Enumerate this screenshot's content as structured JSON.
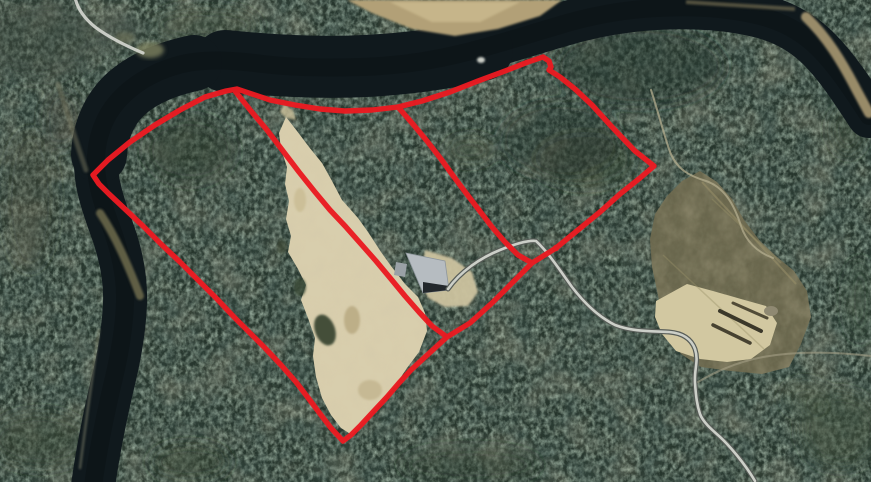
{
  "map": {
    "kind": "aerial-property-boundary-map",
    "colors": {
      "boundary_red": "#ea1b22",
      "forest_base": "#26352c",
      "river_water": "#10191d",
      "river_shadow": "#0b1216",
      "sand_pit": "#d8cead",
      "clearing_olive": "#6f6a4f",
      "clearing_sand": "#d2c8a1",
      "road_fill": "#cccfc8",
      "road_edge": "#585d58",
      "trail_light": "#d6d8d2",
      "trail_faint": "#b4ad8f",
      "building_roof": "#b6bcc1",
      "building_front": "#23282c",
      "sandbar_tan": "#b2a077",
      "bank_olive": "#6f6b4c"
    },
    "boundary": {
      "outer_points": "93,175 108,160 130,142 155,125 180,110 205,97 226,91 237,89 252,94 270,100 295,105 320,109 345,111 372,110 398,107 422,101 450,92 478,81 505,71 528,62 543,57 549,61 551,67 549,70 560,77 575,89 592,105 612,127 635,151 654,166 640,178 620,194 600,212 578,230 556,248 532,263 512,283 492,303 470,323 447,337 436,347 424,358 411,370 399,383 387,397 373,412 361,425 351,435 343,441 331,428 321,415 309,399 296,382 281,365 265,348 250,333 234,317 217,299 199,281 180,262 162,245 144,227 126,210 109,194 99,184",
      "divider_west_points": "235,91 251,111 267,130 283,151 299,172 315,192 330,210 346,227 361,244 376,261 391,279 405,296 419,312 432,326 447,337",
      "divider_east_points": "398,107 412,123 427,141 441,159 454,177 466,193 479,210 492,227 505,242 518,255 532,263",
      "node_cx": "556",
      "node_cy": "248"
    },
    "river": {
      "main_path": "M 93,486 C 98,450 105,416 112,386 C 119,358 124,331 125,303 C 126,276 120,250 110,224 C 101,199 95,179 96,157 C 97,137 104,117 117,102 C 131,86 151,73 175,66 C 201,58 231,60 263,64 C 297,68 331,68 361,67 C 396,66 431,61 463,53 C 496,45 526,35 557,26 C 589,16 621,10 656,8 C 691,6 726,8 756,15 C 783,21 803,33 819,49 C 837,67 852,90 869,116",
      "wide_mid_path": "M 225,61 C 275,66 325,68 365,66 C 408,64 448,58 482,50",
      "wide_bend_path": "M 99,155 C 100,130 110,108 127,93 C 143,79 166,69 194,63"
    },
    "features": {
      "sand_pit_path": "M 286,117 L 297,131 L 309,147 L 322,163 L 332,181 L 342,200 L 358,218 L 368,232 L 381,252 L 391,266 L 405,284 L 418,297 L 425,313 L 427,331 L 419,352 L 407,368 L 395,386 L 378,406 L 363,422 L 352,435 L 341,428 L 331,415 L 322,398 L 316,377 L 313,356 L 315,338 L 308,318 L 301,300 L 306,285 L 298,269 L 288,252 L 291,236 L 286,219 L 289,201 L 285,184 L 287,167 L 281,149 L 279,133 Z",
      "building_apron_path": "M 425,250 L 452,258 L 472,272 L 478,292 L 468,306 L 445,307 L 428,298 L 420,280 Z",
      "clearing_path": "M 655,214 L 667,196 L 682,181 L 700,171 L 717,182 L 732,199 L 744,220 L 760,241 L 777,257 L 794,271 L 807,291 L 811,317 L 801,344 L 789,367 L 762,374 L 731,371 L 701,367 L 681,354 L 668,331 L 659,300 L 652,267 L 650,239 Z",
      "clearing_sand_path": "M 656,301 L 687,284 L 713,291 L 741,299 L 766,306 L 777,323 L 770,345 L 751,359 L 727,362 L 700,359 L 676,351 L 662,334 L 655,317 Z",
      "sandbar_top_points": "347,0 562,0 540,16 498,29 455,36 412,29 372,13",
      "sandbar_top_core_points": "390,2 520,2 480,22 432,22",
      "building_roof_points": "406,253 445,261 449,290 423,293",
      "building_front_points": "423,282 449,286 449,290 423,293",
      "building_annex_points": "396,262 407,264 405,277 394,275",
      "river_rock_cx": "481",
      "river_rock_cy": "60"
    },
    "roads": {
      "main_road_path": "M 448,289 C 460,272 480,258 500,250 C 515,244 528,240 536,241 C 548,252 559,269 572,287 C 585,304 599,317 615,325 C 633,332 653,331 669,332 C 681,333 691,338 695,349 C 699,361 694,369 695,383 C 696,397 697,405 700,414 C 703,422 711,429 719,436 C 730,446 745,464 755,481",
      "trail_topleft_path": "M 75,-3 C 77,8 84,18 95,27 C 107,36 124,45 143,53",
      "trail_east_path": "M 651,90 C 657,108 662,128 669,149 C 676,170 690,176 706,181 C 724,187 734,204 741,226 C 746,241 757,252 773,258",
      "trail_right_path": "M 698,382 C 715,372 736,362 763,357 C 796,351 836,352 871,356",
      "sandbar_right_path": "M 806,17 C 827,37 842,62 856,89 L 869,113",
      "bank_bend_path": "M 58,84 C 67,112 76,142 86,170",
      "bank_streak_path": "M 100,213 C 116,237 128,265 140,296",
      "bank_lower_path": "M 99,330 C 93,372 86,420 80,468"
    }
  }
}
